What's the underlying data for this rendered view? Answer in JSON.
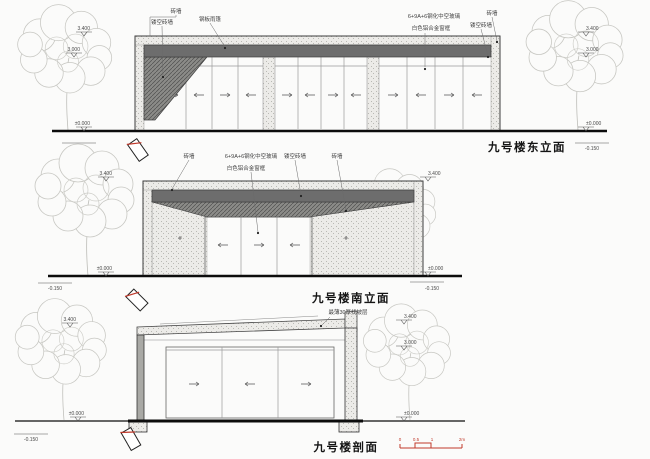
{
  "east": {
    "title": "九号楼东立面",
    "labels": {
      "l1": "砖墙",
      "l2": "镂空砖墙",
      "l3": "钢板雨篷",
      "r1": "6+9A+6钢化中空玻璃",
      "r2": "白色铝合金窗框",
      "r3": "砖墙",
      "r4": "镂空砖墙"
    },
    "levels": {
      "left_top": "3.400",
      "left_mid": "3.000",
      "left_zero": "±0.000",
      "left_below": "-0.150",
      "right_top": "3.400",
      "right_mid": "3.000",
      "right_zero": "±0.000",
      "right_below": "-0.150"
    }
  },
  "south": {
    "title": "九号楼南立面",
    "labels": {
      "l1": "砖墙",
      "c1": "6+9A+6钢化中空玻璃",
      "c2": "白色铝合金窗框",
      "r1": "镂空砖墙",
      "r2": "砖墙"
    },
    "levels": {
      "left_top": "3.400",
      "left_zero": "±0.000",
      "left_below": "-0.150",
      "right_top": "3.400",
      "right_zero": "±0.000",
      "right_below": "-0.150"
    }
  },
  "section": {
    "title": "九号楼剖面",
    "labels": {
      "screed": "最薄30厚找坡层"
    },
    "levels": {
      "left_top": "3.400",
      "left_zero": "±0.000",
      "left_below": "-0.150",
      "right_top": "3.400",
      "right_mid": "3.000",
      "right_zero": "±0.000"
    },
    "scalebar": {
      "t0": "0",
      "t1": "0.5",
      "t2": "1",
      "t3": "2m"
    }
  },
  "colors": {
    "accent_red": "#c0392b",
    "canopy_gray": "#6d6d6d",
    "brick_dot": "#b9b9b4"
  }
}
